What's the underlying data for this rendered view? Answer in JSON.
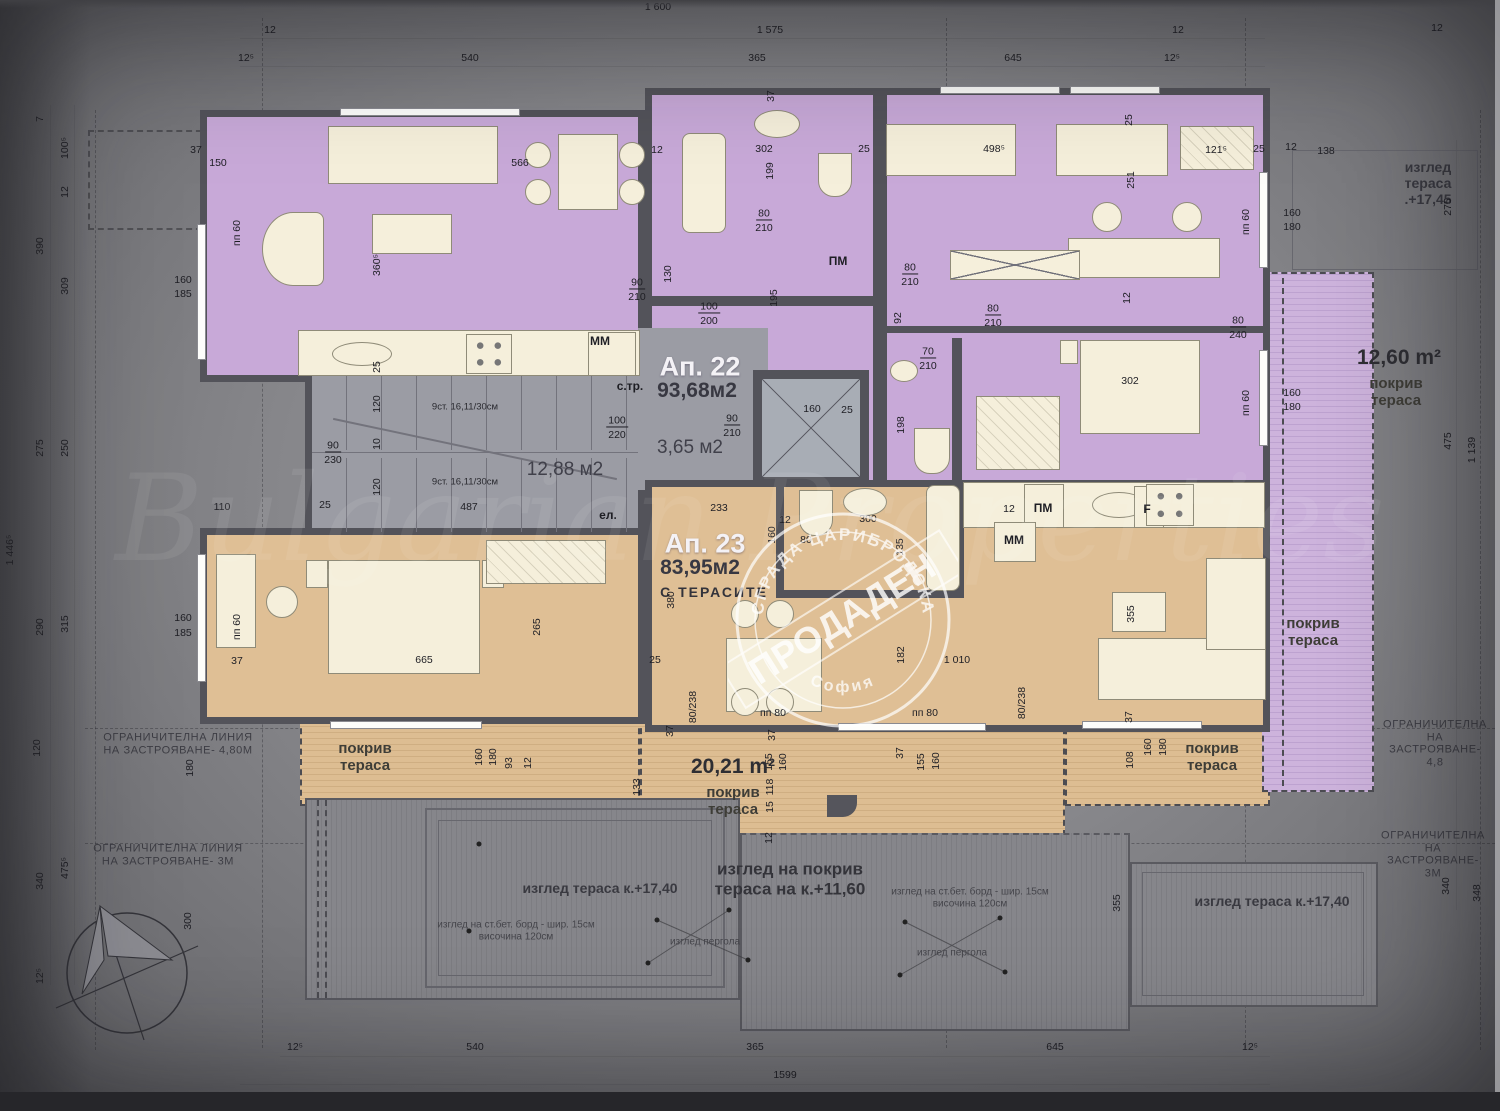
{
  "title": "Top floor plan — building Tsaribrodska, Sofia",
  "apartments": [
    {
      "id": "ap22",
      "label": "Ап. 22",
      "area": "93,68м2",
      "color": "#c8a9d8"
    },
    {
      "id": "ap23",
      "label": "Ап. 23",
      "area": "83,95м2",
      "note": "С ТЕРАСИТЕ",
      "color": "#dfbf95"
    }
  ],
  "stamp": {
    "arc_top": "СГРАДА ЦАРИБРОДСКА",
    "arc_bottom": "София",
    "band": "ПРОДАДЕН"
  },
  "watermark": "Bulgarian Properties",
  "colors": {
    "wall": "#53535a",
    "ap22_room": "#c8a9d8",
    "ap23_room": "#dfbf95",
    "terrace_tan": "#ddbd92",
    "terrace_purple": "#cdb3dc",
    "stair_gray": "#9b9ca4",
    "furniture": "#f5efdb",
    "background": "#87878b"
  },
  "annotations": [
    {
      "t": "1 600",
      "x": 658,
      "y": 7,
      "c": "dim"
    },
    {
      "t": "1 575",
      "x": 770,
      "y": 30,
      "c": "dim"
    },
    {
      "t": "12",
      "x": 270,
      "y": 30,
      "c": "dim"
    },
    {
      "t": "12⁵",
      "x": 246,
      "y": 58,
      "c": "dim"
    },
    {
      "t": "540",
      "x": 470,
      "y": 58,
      "c": "dim"
    },
    {
      "t": "365",
      "x": 757,
      "y": 58,
      "c": "dim"
    },
    {
      "t": "645",
      "x": 1013,
      "y": 58,
      "c": "dim"
    },
    {
      "t": "12⁵",
      "x": 1172,
      "y": 58,
      "c": "dim"
    },
    {
      "t": "12",
      "x": 1178,
      "y": 30,
      "c": "dim"
    },
    {
      "t": "12",
      "x": 1437,
      "y": 28,
      "c": "dim"
    },
    {
      "t": "25",
      "x": 1259,
      "y": 149,
      "c": "dim"
    },
    {
      "t": "12",
      "x": 1291,
      "y": 147,
      "c": "dim"
    },
    {
      "t": "138",
      "x": 1326,
      "y": 151,
      "c": "dim"
    },
    {
      "t": "изглед тераса .+17,45",
      "x": 1428,
      "y": 183,
      "c": "view"
    },
    {
      "t": "275",
      "x": 1448,
      "y": 207,
      "c": "dimr"
    },
    {
      "t": "475",
      "x": 1448,
      "y": 441,
      "c": "dimr"
    },
    {
      "t": "1 139",
      "x": 1472,
      "y": 450,
      "c": "dimr"
    },
    {
      "t": "340",
      "x": 1446,
      "y": 886,
      "c": "dimr"
    },
    {
      "t": "348",
      "x": 1477,
      "y": 893,
      "c": "dimr"
    },
    {
      "t": "7",
      "x": 40,
      "y": 119,
      "c": "dimr"
    },
    {
      "t": "100⁵",
      "x": 65,
      "y": 148,
      "c": "dimr"
    },
    {
      "t": "12",
      "x": 65,
      "y": 192,
      "c": "dimr"
    },
    {
      "t": "390",
      "x": 40,
      "y": 246,
      "c": "dimr"
    },
    {
      "t": "309",
      "x": 65,
      "y": 286,
      "c": "dimr"
    },
    {
      "t": "275",
      "x": 40,
      "y": 448,
      "c": "dimr"
    },
    {
      "t": "250",
      "x": 65,
      "y": 448,
      "c": "dimr"
    },
    {
      "t": "1 446⁵",
      "x": 10,
      "y": 550,
      "c": "dimr"
    },
    {
      "t": "290",
      "x": 40,
      "y": 627,
      "c": "dimr"
    },
    {
      "t": "315",
      "x": 65,
      "y": 624,
      "c": "dimr"
    },
    {
      "t": "120",
      "x": 37,
      "y": 748,
      "c": "dimr"
    },
    {
      "t": "180",
      "x": 190,
      "y": 768,
      "c": "dimr"
    },
    {
      "t": "475⁵",
      "x": 65,
      "y": 868,
      "c": "dimr"
    },
    {
      "t": "340",
      "x": 40,
      "y": 881,
      "c": "dimr"
    },
    {
      "t": "12⁵",
      "x": 40,
      "y": 976,
      "c": "dimr"
    },
    {
      "t": "300",
      "x": 188,
      "y": 921,
      "c": "dimr"
    },
    {
      "t": "12⁵",
      "x": 295,
      "y": 1047,
      "c": "dim"
    },
    {
      "t": "540",
      "x": 475,
      "y": 1047,
      "c": "dim"
    },
    {
      "t": "365",
      "x": 755,
      "y": 1047,
      "c": "dim"
    },
    {
      "t": "645",
      "x": 1055,
      "y": 1047,
      "c": "dim"
    },
    {
      "t": "12⁵",
      "x": 1250,
      "y": 1047,
      "c": "dim"
    },
    {
      "t": "1599",
      "x": 785,
      "y": 1075,
      "c": "dim"
    },
    {
      "t": "37",
      "x": 196,
      "y": 150,
      "c": "dim"
    },
    {
      "t": "150",
      "x": 218,
      "y": 163,
      "c": "dim"
    },
    {
      "t": "566",
      "x": 520,
      "y": 163,
      "c": "dim"
    },
    {
      "t": "360⁵",
      "x": 377,
      "y": 265,
      "c": "dimr"
    },
    {
      "t": "пп 60",
      "x": 237,
      "y": 233,
      "c": "dimr"
    },
    {
      "t": "160",
      "x": 183,
      "y": 280,
      "c": "dim"
    },
    {
      "t": "185",
      "x": 183,
      "y": 294,
      "c": "dim"
    },
    {
      "t": "ММ",
      "x": 600,
      "y": 342,
      "c": "dimb"
    },
    {
      "t": "90",
      "x": 637,
      "y": 283,
      "c": "dimu"
    },
    {
      "t": "210",
      "x": 637,
      "y": 297,
      "c": "dim"
    },
    {
      "t": "130",
      "x": 668,
      "y": 274,
      "c": "dimr"
    },
    {
      "t": "12",
      "x": 657,
      "y": 150,
      "c": "dim"
    },
    {
      "t": "25",
      "x": 377,
      "y": 367,
      "c": "dimr"
    },
    {
      "t": "120",
      "x": 377,
      "y": 404,
      "c": "dimr"
    },
    {
      "t": "10",
      "x": 377,
      "y": 444,
      "c": "dimr"
    },
    {
      "t": "120",
      "x": 377,
      "y": 487,
      "c": "dimr"
    },
    {
      "t": "9ст. 16,11/30см",
      "x": 465,
      "y": 408,
      "c": "dims"
    },
    {
      "t": "9ст. 16,11/30см",
      "x": 465,
      "y": 483,
      "c": "dims"
    },
    {
      "t": "487",
      "x": 469,
      "y": 507,
      "c": "dim"
    },
    {
      "t": "12,88 м2",
      "x": 565,
      "y": 470,
      "c": "room-area"
    },
    {
      "t": "с.тр.",
      "x": 630,
      "y": 387,
      "c": "dimb"
    },
    {
      "t": "ел.",
      "x": 608,
      "y": 516,
      "c": "dimb"
    },
    {
      "t": "100",
      "x": 617,
      "y": 421,
      "c": "dimu"
    },
    {
      "t": "220",
      "x": 617,
      "y": 435,
      "c": "dim"
    },
    {
      "t": "90",
      "x": 333,
      "y": 446,
      "c": "dimu"
    },
    {
      "t": "230",
      "x": 333,
      "y": 460,
      "c": "dim"
    },
    {
      "t": "25",
      "x": 325,
      "y": 505,
      "c": "dim"
    },
    {
      "t": "110",
      "x": 222,
      "y": 507,
      "c": "dim"
    },
    {
      "t": "Ап. 22",
      "x": 700,
      "y": 367,
      "c": "apt-title"
    },
    {
      "t": "93,68м2",
      "x": 697,
      "y": 391,
      "c": "apt-area"
    },
    {
      "t": "3,65 м2",
      "x": 690,
      "y": 448,
      "c": "room-area"
    },
    {
      "t": "302",
      "x": 764,
      "y": 149,
      "c": "dim"
    },
    {
      "t": "199",
      "x": 770,
      "y": 171,
      "c": "dimr"
    },
    {
      "t": "80",
      "x": 764,
      "y": 214,
      "c": "dimu"
    },
    {
      "t": "210",
      "x": 764,
      "y": 228,
      "c": "dim"
    },
    {
      "t": "ПМ",
      "x": 838,
      "y": 262,
      "c": "dimb"
    },
    {
      "t": "100",
      "x": 709,
      "y": 307,
      "c": "dimu"
    },
    {
      "t": "200",
      "x": 709,
      "y": 321,
      "c": "dim"
    },
    {
      "t": "195",
      "x": 774,
      "y": 298,
      "c": "dimr"
    },
    {
      "t": "37",
      "x": 771,
      "y": 96,
      "c": "dimr"
    },
    {
      "t": "25",
      "x": 864,
      "y": 149,
      "c": "dim"
    },
    {
      "t": "80",
      "x": 910,
      "y": 268,
      "c": "dimu"
    },
    {
      "t": "210",
      "x": 910,
      "y": 282,
      "c": "dim"
    },
    {
      "t": "92",
      "x": 898,
      "y": 318,
      "c": "dimr"
    },
    {
      "t": "70",
      "x": 928,
      "y": 352,
      "c": "dimu"
    },
    {
      "t": "210",
      "x": 928,
      "y": 366,
      "c": "dim"
    },
    {
      "t": "198",
      "x": 901,
      "y": 425,
      "c": "dimr"
    },
    {
      "t": "160",
      "x": 812,
      "y": 409,
      "c": "dim"
    },
    {
      "t": "25",
      "x": 847,
      "y": 410,
      "c": "dim"
    },
    {
      "t": "90",
      "x": 732,
      "y": 419,
      "c": "dimu"
    },
    {
      "t": "210",
      "x": 732,
      "y": 433,
      "c": "dim"
    },
    {
      "t": "498⁵",
      "x": 994,
      "y": 149,
      "c": "dim"
    },
    {
      "t": "121⁵",
      "x": 1216,
      "y": 150,
      "c": "dim"
    },
    {
      "t": "251",
      "x": 1131,
      "y": 180,
      "c": "dimr"
    },
    {
      "t": "25",
      "x": 1129,
      "y": 120,
      "c": "dimr"
    },
    {
      "t": "пп 60",
      "x": 1246,
      "y": 222,
      "c": "dimr"
    },
    {
      "t": "160",
      "x": 1292,
      "y": 213,
      "c": "dim"
    },
    {
      "t": "180",
      "x": 1292,
      "y": 227,
      "c": "dim"
    },
    {
      "t": "80",
      "x": 993,
      "y": 309,
      "c": "dimu"
    },
    {
      "t": "210",
      "x": 993,
      "y": 323,
      "c": "dim"
    },
    {
      "t": "12",
      "x": 1127,
      "y": 298,
      "c": "dimr"
    },
    {
      "t": "80",
      "x": 1238,
      "y": 321,
      "c": "dimu"
    },
    {
      "t": "240",
      "x": 1238,
      "y": 335,
      "c": "dim"
    },
    {
      "t": "302",
      "x": 1130,
      "y": 381,
      "c": "dim"
    },
    {
      "t": "160",
      "x": 1292,
      "y": 393,
      "c": "dim"
    },
    {
      "t": "180",
      "x": 1292,
      "y": 407,
      "c": "dim"
    },
    {
      "t": "пп 60",
      "x": 1246,
      "y": 403,
      "c": "dimr"
    },
    {
      "t": "Ап. 23",
      "x": 705,
      "y": 544,
      "c": "apt-title"
    },
    {
      "t": "83,95м2",
      "x": 700,
      "y": 568,
      "c": "apt-area"
    },
    {
      "t": "С ТЕРАСИТЕ",
      "x": 714,
      "y": 592,
      "c": "apt-note"
    },
    {
      "t": "233",
      "x": 719,
      "y": 508,
      "c": "dim"
    },
    {
      "t": "12",
      "x": 785,
      "y": 520,
      "c": "dim"
    },
    {
      "t": "160",
      "x": 772,
      "y": 535,
      "c": "dimr"
    },
    {
      "t": "80",
      "x": 806,
      "y": 540,
      "c": "dim"
    },
    {
      "t": "300",
      "x": 868,
      "y": 519,
      "c": "dim"
    },
    {
      "t": "135",
      "x": 900,
      "y": 547,
      "c": "dimr"
    },
    {
      "t": "380",
      "x": 671,
      "y": 600,
      "c": "dimr"
    },
    {
      "t": "25",
      "x": 655,
      "y": 660,
      "c": "dim"
    },
    {
      "t": "182",
      "x": 901,
      "y": 655,
      "c": "dimr"
    },
    {
      "t": "1 010",
      "x": 957,
      "y": 660,
      "c": "dim"
    },
    {
      "t": "12",
      "x": 1009,
      "y": 509,
      "c": "dim"
    },
    {
      "t": "ПМ",
      "x": 1043,
      "y": 509,
      "c": "dimb"
    },
    {
      "t": "ММ",
      "x": 1014,
      "y": 541,
      "c": "dimb"
    },
    {
      "t": "F",
      "x": 1147,
      "y": 510,
      "c": "dimb"
    },
    {
      "t": "665",
      "x": 424,
      "y": 660,
      "c": "dim"
    },
    {
      "t": "265",
      "x": 537,
      "y": 627,
      "c": "dimr"
    },
    {
      "t": "37",
      "x": 237,
      "y": 661,
      "c": "dim"
    },
    {
      "t": "160",
      "x": 183,
      "y": 618,
      "c": "dim"
    },
    {
      "t": "185",
      "x": 183,
      "y": 633,
      "c": "dim"
    },
    {
      "t": "пп 60",
      "x": 237,
      "y": 627,
      "c": "dimr"
    },
    {
      "t": "355",
      "x": 1131,
      "y": 614,
      "c": "dimr"
    },
    {
      "t": "37",
      "x": 1129,
      "y": 717,
      "c": "dimr"
    },
    {
      "t": "80/238",
      "x": 693,
      "y": 707,
      "c": "dimr"
    },
    {
      "t": "80/238",
      "x": 1022,
      "y": 703,
      "c": "dimr"
    },
    {
      "t": "пп 80",
      "x": 773,
      "y": 713,
      "c": "dim"
    },
    {
      "t": "пп 80",
      "x": 925,
      "y": 713,
      "c": "dim"
    },
    {
      "t": "160",
      "x": 479,
      "y": 757,
      "c": "dimr"
    },
    {
      "t": "180",
      "x": 493,
      "y": 757,
      "c": "dimr"
    },
    {
      "t": "93",
      "x": 509,
      "y": 763,
      "c": "dimr"
    },
    {
      "t": "12",
      "x": 528,
      "y": 763,
      "c": "dimr"
    },
    {
      "t": "133",
      "x": 637,
      "y": 787,
      "c": "dimr"
    },
    {
      "t": "155",
      "x": 769,
      "y": 762,
      "c": "dimr"
    },
    {
      "t": "160",
      "x": 783,
      "y": 762,
      "c": "dimr"
    },
    {
      "t": "118",
      "x": 770,
      "y": 787,
      "c": "dimr"
    },
    {
      "t": "15",
      "x": 770,
      "y": 807,
      "c": "dimr"
    },
    {
      "t": "12",
      "x": 769,
      "y": 838,
      "c": "dimr"
    },
    {
      "t": "37",
      "x": 670,
      "y": 731,
      "c": "dimr"
    },
    {
      "t": "37",
      "x": 772,
      "y": 735,
      "c": "dimr"
    },
    {
      "t": "155",
      "x": 921,
      "y": 762,
      "c": "dimr"
    },
    {
      "t": "160",
      "x": 936,
      "y": 761,
      "c": "dimr"
    },
    {
      "t": "37",
      "x": 900,
      "y": 753,
      "c": "dimr"
    },
    {
      "t": "108",
      "x": 1130,
      "y": 760,
      "c": "dimr"
    },
    {
      "t": "160",
      "x": 1148,
      "y": 747,
      "c": "dimr"
    },
    {
      "t": "180",
      "x": 1163,
      "y": 747,
      "c": "dimr"
    },
    {
      "t": "355",
      "x": 1117,
      "y": 903,
      "c": "dimr"
    },
    {
      "t": "покрив\nтераса",
      "x": 365,
      "y": 757,
      "c": "t-lab"
    },
    {
      "t": "20,21 m²",
      "x": 733,
      "y": 767,
      "c": "t-big"
    },
    {
      "t": "покрив\nтераса",
      "x": 733,
      "y": 801,
      "c": "t-lab"
    },
    {
      "t": "покрив\nтераса",
      "x": 1212,
      "y": 757,
      "c": "t-lab"
    },
    {
      "t": "покрив\nтераса",
      "x": 1313,
      "y": 632,
      "c": "t-lab"
    },
    {
      "t": "12,60 m²",
      "x": 1399,
      "y": 358,
      "c": "t-big"
    },
    {
      "t": "покрив\nтераса",
      "x": 1396,
      "y": 392,
      "c": "t-lab"
    },
    {
      "t": "изглед тераса к.+17,40",
      "x": 600,
      "y": 888,
      "c": "view"
    },
    {
      "t": "изглед на ст.бет. борд - шир. 15см\nвисочина 120см",
      "x": 516,
      "y": 931,
      "c": "view-sm"
    },
    {
      "t": "изглед на покрив\nтераса на к.+11,60",
      "x": 790,
      "y": 879,
      "c": "view-big"
    },
    {
      "t": "изглед пергола",
      "x": 705,
      "y": 942,
      "c": "view-sm"
    },
    {
      "t": "изглед пергола",
      "x": 952,
      "y": 953,
      "c": "view-sm"
    },
    {
      "t": "изглед на ст.бет. борд - шир. 15см\nвисочина 120см",
      "x": 970,
      "y": 898,
      "c": "view-sm"
    },
    {
      "t": "изглед тераса к.+17,40",
      "x": 1272,
      "y": 901,
      "c": "view"
    },
    {
      "t": "ОГРАНИЧИТЕЛНА ЛИНИЯ\nНА ЗАСТРОЯВАНЕ- 4,80М",
      "x": 178,
      "y": 744,
      "c": "limit"
    },
    {
      "t": "ОГРАНИЧИТЕЛНА ЛИНИЯ\nНА ЗАСТРОЯВАНЕ- 3М",
      "x": 168,
      "y": 855,
      "c": "limit"
    },
    {
      "t": "ОГРАНИЧИТЕЛНА\nНА ЗАСТРОЯВАНЕ- 4,8",
      "x": 1435,
      "y": 744,
      "c": "limit"
    },
    {
      "t": "ОГРАНИЧИТЕЛНА\nНА ЗАСТРОЯВАНЕ- 3М",
      "x": 1433,
      "y": 855,
      "c": "limit"
    },
    {
      "t": "Bulgarian Properties",
      "x": 750,
      "y": 520,
      "c": "wm"
    }
  ]
}
